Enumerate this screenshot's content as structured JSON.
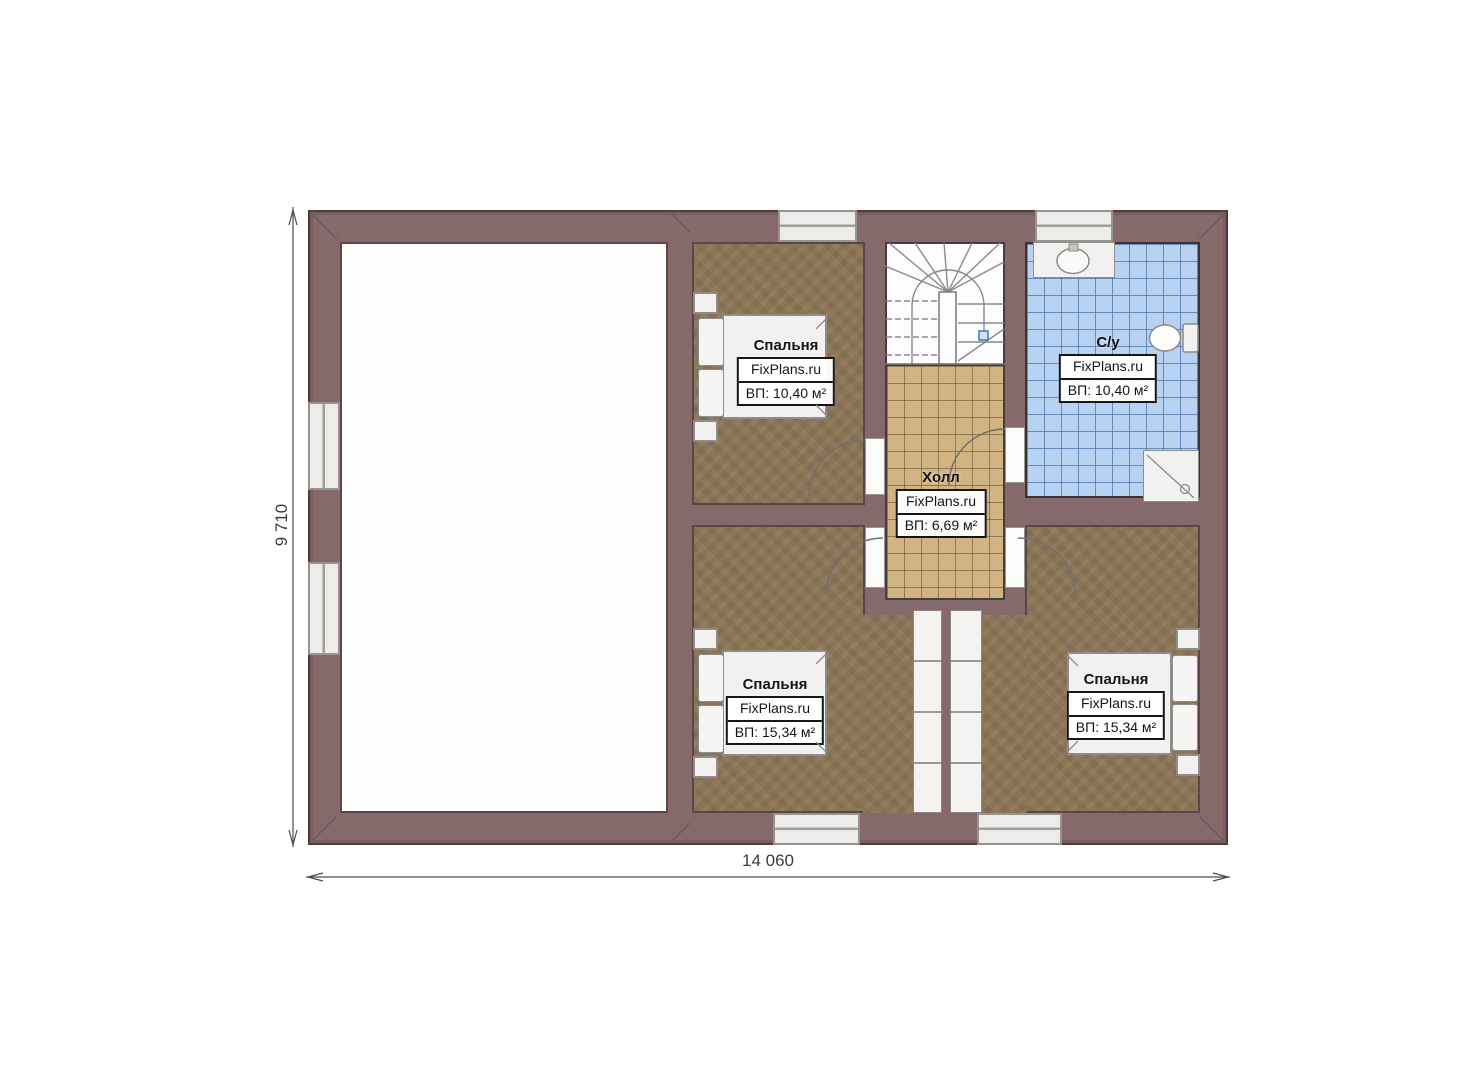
{
  "branding": "FixPlans.ru",
  "dimensions": {
    "width_label": "14 060",
    "height_label": "9 710"
  },
  "rooms": [
    {
      "key": "bedroom-top",
      "name": "Спальня",
      "brand": "FixPlans.ru",
      "area": "ВП: 10,40 м²"
    },
    {
      "key": "bathroom",
      "name": "С/у",
      "brand": "FixPlans.ru",
      "area": "ВП: 10,40 м²"
    },
    {
      "key": "hall",
      "name": "Холл",
      "brand": "FixPlans.ru",
      "area": "ВП: 6,69 м²"
    },
    {
      "key": "bedroom-bottom-left",
      "name": "Спальня",
      "brand": "FixPlans.ru",
      "area": "ВП: 15,34 м²"
    },
    {
      "key": "bedroom-bottom-right",
      "name": "Спальня",
      "brand": "FixPlans.ru",
      "area": "ВП: 15,34 м²"
    }
  ],
  "colors": {
    "wall": "#85696b",
    "wall_outline": "#4f3b3d",
    "bedroom_floor": "#8c7556",
    "hall_tile": "#d2b483",
    "bathroom_tile": "#b7d3f1",
    "window_fill": "#edecea",
    "fixture_fill": "#f2f1ef",
    "walkline_marker": "#4a72b8"
  },
  "fixtures": [
    "bed",
    "nightstand",
    "wardrobe",
    "winder-stairs",
    "sink",
    "toilet",
    "shower",
    "door",
    "window"
  ]
}
